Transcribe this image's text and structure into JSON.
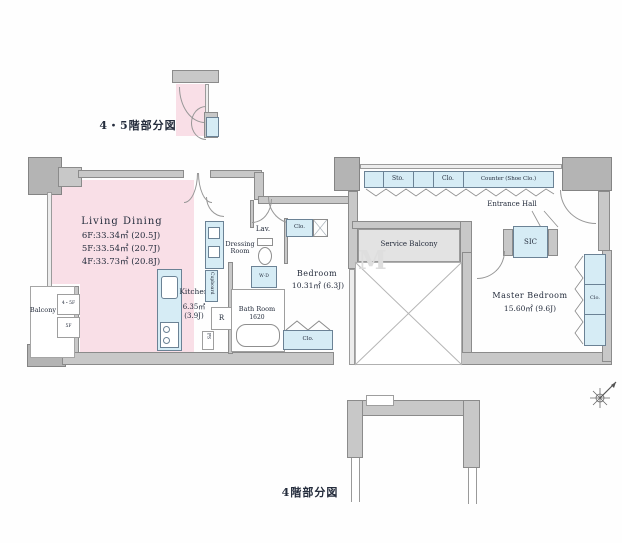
{
  "titles": {
    "upper_detail": "4・5階部分図",
    "lower_detail": "4階部分図"
  },
  "living_dining": {
    "name": "Living Dining",
    "areas": [
      "6F:33.34㎡ (20.5J)",
      "5F:33.54㎡ (20.7J)",
      "4F:33.73㎡ (20.8J)"
    ]
  },
  "kitchen": {
    "name": "Kitchen",
    "area": "6.35㎡",
    "tatami": "(3.9J)"
  },
  "bedroom": {
    "name": "Bedroom",
    "area": "10.31㎡ (6.3J)"
  },
  "master_bedroom": {
    "name": "Master Bedroom",
    "area": "15.60㎡ (9.6J)"
  },
  "bath_room": {
    "name": "Bath Room",
    "size": "1620"
  },
  "dressing_room": {
    "line1": "Dressing",
    "line2": "Room"
  },
  "lavatory": {
    "name": "Lav."
  },
  "balcony": {
    "name": "Balcony",
    "tag_upper": "4・5F",
    "tag_lower": "5F"
  },
  "service_balcony": {
    "name": "Service Balcony"
  },
  "entrance_hall": {
    "name": "Entrance Hall"
  },
  "sic": {
    "name": "SIC"
  },
  "storage_row": {
    "sto": "Sto.",
    "clo": "Clo.",
    "counter": "Counter (Shoe Clo.)"
  },
  "closets": {
    "lav_clo": "Clo.",
    "bedroom_clo": "Clo.",
    "master_clo": "Clo."
  },
  "fixtures": {
    "cupboard": "Cupboard",
    "refrigerator": "R",
    "pipe_space": "PS",
    "washer": "W·D"
  },
  "watermark": "M",
  "colors": {
    "wall": "#c8c8c8",
    "wall_dark": "#b4b4b4",
    "pink": "#f9dfe7",
    "storage_blue": "#d6ecf5",
    "service_gray": "#e3e3e3"
  }
}
